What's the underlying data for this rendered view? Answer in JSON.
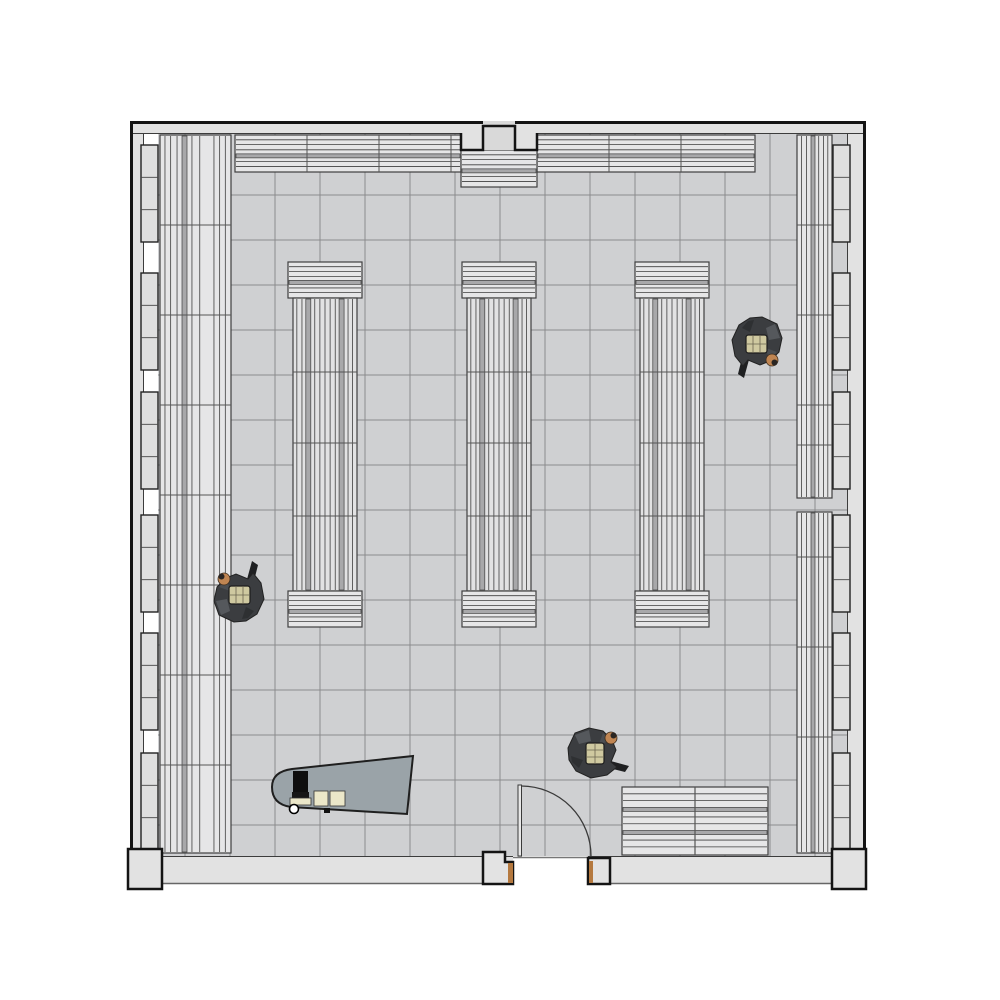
{
  "meta": {
    "description": "Top-down architectural floor plan of a room with wall shelving, three gondola shelf columns, checkout desk, entrance door and three people",
    "canvas": {
      "w": 1000,
      "h": 1000
    }
  },
  "colors": {
    "background": "#ffffff",
    "wall_fill": "#e2e2e2",
    "wall_recess_fill": "#d9d9d9",
    "wall_outline": "#141414",
    "wall_inner_line": "#3c3c3c",
    "pier_fill": "#dfdfdf",
    "pier_line": "#222222",
    "floor_fill": "#cfd0d2",
    "tile_line": "#8b8b8d",
    "shelf_fill": "#e6e6e7",
    "shelf_line": "#3f3f3f",
    "shelf_stripe": "#a8a8aa",
    "shelf_divider": "#555555",
    "gondola_body_fill": "#e2e2e3",
    "desk_fill": "#9aa3a8",
    "desk_outline": "#1f1f1f",
    "monitor": "#0e0e0e",
    "paper": "#ebe7c9",
    "threshold_line": "#777777",
    "door_frame_fill": "#e3e3e3",
    "door_frame_tan": "#b5793f",
    "door_leaf_fill": "#e8e8e8",
    "door_line": "#3a3a3a",
    "person_body": "#3b3d40",
    "person_body_light": "#55585c",
    "person_body_mid": "#4b4e52",
    "person_body_dark": "#2e3032",
    "person_torso": "#cfc9a0",
    "person_torso_line": "#6b6550",
    "person_skin": "#c08552",
    "person_hair": "#2b2623",
    "person_wedge": "#1f2022"
  },
  "floor": {
    "x": 158,
    "y": 133,
    "w": 690,
    "h": 723,
    "tile_size": 45,
    "grid_x0": 185,
    "grid_y0": 195
  },
  "walls": {
    "outer": {
      "left_x": 131.5,
      "top_y": 122.5,
      "right_x": 864.5,
      "bottom_y": 889
    },
    "top_band": {
      "x": 130,
      "y": 121,
      "w": 736,
      "h": 12
    },
    "left_band": {
      "x": 130,
      "y": 121,
      "w": 13,
      "h": 735
    },
    "right_band": {
      "x": 848,
      "y": 121,
      "w": 18,
      "h": 735
    },
    "bottom_band_left": {
      "x": 146,
      "y": 856,
      "w": 367,
      "h": 28
    },
    "bottom_band_right": {
      "x": 588,
      "y": 856,
      "w": 264,
      "h": 28
    },
    "corner_blocks": [
      {
        "x": 128,
        "y": 849,
        "w": 34,
        "h": 40
      },
      {
        "x": 832,
        "y": 849,
        "w": 34,
        "h": 40
      }
    ],
    "pier_ys": [
      145,
      273,
      392,
      515,
      633,
      753
    ],
    "pier_h": 97,
    "left_pier_x": 141,
    "right_pier_x": 833,
    "pier_w": 17,
    "top_pier": {
      "fill_rect": {
        "x": 461,
        "y": 133,
        "w": 76,
        "h": 17
      },
      "recess": {
        "x": 483,
        "y": 121,
        "w": 32,
        "h": 29
      },
      "outline_path": "M461,133 V150 H483 V126 H515 V150 H537 V133"
    }
  },
  "shelves": {
    "top_runs": [
      {
        "x": 235,
        "y": 135,
        "w": 226,
        "h": 37,
        "dividers": [
          307,
          379,
          451
        ]
      },
      {
        "x": 537,
        "y": 135,
        "w": 218,
        "h": 37,
        "dividers": [
          609,
          681
        ]
      }
    ],
    "center_block": {
      "x": 461,
      "y": 150,
      "w": 76,
      "h": 37
    },
    "left_run": {
      "x": 160,
      "y": 135,
      "w": 71,
      "h": 718,
      "dividers": [
        225,
        315,
        405,
        495,
        585,
        675,
        765
      ]
    },
    "right_run_sections": [
      {
        "x": 797,
        "y": 135,
        "w": 35,
        "h": 363,
        "dividers": [
          225,
          315,
          405,
          445
        ]
      },
      {
        "x": 797,
        "y": 512,
        "w": 35,
        "h": 341,
        "dividers": [
          557,
          647,
          737
        ]
      }
    ],
    "bottom_unit": {
      "x": 622,
      "y": 787,
      "w": 146,
      "h": 68,
      "divider_x": 695
    },
    "gondolas": {
      "xs": [
        288,
        462,
        635
      ],
      "w": 74,
      "cap_h": 36,
      "top_cap_y": 262,
      "body_y": 298,
      "body_h": 293,
      "body_inset": 5,
      "body_dividers": [
        372,
        443,
        516
      ],
      "bottom_cap_y": 591
    }
  },
  "desk": {
    "outline_path": "M413,756 L292,769 C277,771 272,778 272,787 C272,797 277,805 291,807 L407,814 Z",
    "monitor": {
      "x": 293,
      "y": 771,
      "w": 15,
      "h": 21
    },
    "monitor_base": {
      "x": 292,
      "y": 792,
      "w": 17,
      "h": 6
    },
    "keyboard": {
      "x": 290,
      "y": 798,
      "w": 21,
      "h": 7
    },
    "papers": [
      {
        "x": 314,
        "y": 791,
        "w": 14,
        "h": 15
      },
      {
        "x": 330,
        "y": 791,
        "w": 15,
        "h": 15
      }
    ],
    "chip": {
      "x": 324,
      "y": 808,
      "w": 6,
      "h": 5
    },
    "cup": {
      "cx": 294,
      "cy": 809,
      "r": 4.5
    }
  },
  "door": {
    "jamb_left_path": "M483,852 H505 V862 H513 V884 H483 Z",
    "jamb_left_tan": {
      "x": 508,
      "y": 863,
      "w": 5,
      "h": 20
    },
    "jamb_right": {
      "x": 588,
      "y": 858,
      "w": 22,
      "h": 26
    },
    "jamb_right_tan": {
      "x": 589,
      "y": 861,
      "w": 4,
      "h": 22
    },
    "leaf": {
      "x": 518,
      "y": 785,
      "w": 3.5,
      "h": 71
    },
    "arc_path": "M 521.5 786 A 70 70 0 0 1 591 856",
    "threshold": {
      "x1": 513,
      "x2": 588,
      "y": 857.5
    }
  },
  "people": [
    {
      "cx": 756,
      "cy": 344,
      "rot": 90
    },
    {
      "cx": 240,
      "cy": 595,
      "rot": -90
    },
    {
      "cx": 595,
      "cy": 754,
      "rot": 0
    }
  ]
}
